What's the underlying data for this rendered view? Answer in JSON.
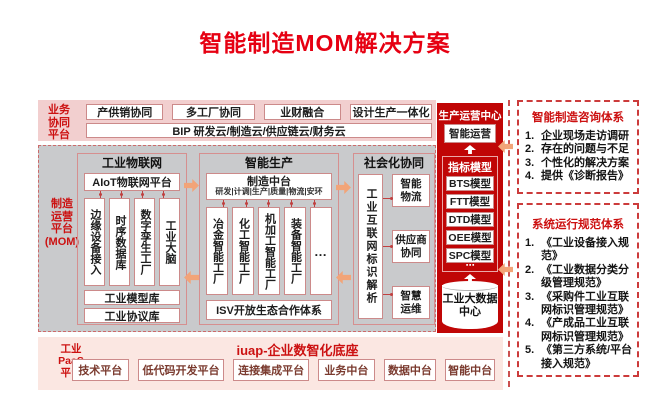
{
  "title": "智能制造MOM解决方案",
  "colors": {
    "accent": "#e60012",
    "panel_red": "#c00606",
    "arrow": "#f2a478",
    "band_pink": "#f2cfcf",
    "band_gray": "#c9cacc"
  },
  "layers": {
    "business": {
      "label": "业务协同平台",
      "boxes": [
        "产供销协同",
        "多工厂协同",
        "业财融合",
        "设计生产一体化"
      ],
      "bip": "BIP 研发云/制造云/供应链云/财务云"
    },
    "mom": {
      "label": "制造\n运营\n平台\n(MOM)",
      "iot": {
        "title": "工业物联网",
        "platform": "AIoT物联网平台",
        "columns": [
          "边缘设备接入",
          "时序数据库",
          "数字孪生工厂",
          "工业大脑"
        ],
        "libraries": [
          "工业模型库",
          "工业协议库"
        ]
      },
      "production": {
        "title": "智能生产",
        "hub": "制造中台",
        "hub_domains": "研发|计调|生产|质量|物流|安环",
        "factories": [
          "冶金智能工厂",
          "化工智能工厂",
          "机加工智能工厂",
          "装备智能工厂",
          "…"
        ],
        "isv": "ISV开放生态合作体系"
      },
      "social": {
        "title": "社会化协同",
        "resolver": "工业互联网标识解析",
        "items": [
          "智能\n物流",
          "供应商\n协同",
          "智慧\n运维"
        ]
      }
    },
    "paas": {
      "label": "工业\nPaaS\n平台",
      "title": "iuap-企业数智化底座",
      "boxes": [
        "技术平台",
        "低代码开发平台",
        "连接集成平台",
        "业务中台",
        "数据中台",
        "智能中台"
      ]
    }
  },
  "operation_center": {
    "title": "生产运营中心",
    "ops": "智能运营",
    "kpi": {
      "title": "指标模型",
      "models": [
        "BTS模型",
        "FTT模型",
        "DTD模型",
        "OEE模型",
        "SPC模型"
      ],
      "more": "⋯"
    },
    "datacenter": "工业大数据中心"
  },
  "consulting_panel": {
    "title": "智能制造咨询体系",
    "items": [
      {
        "no": "1.",
        "text": "企业现场走访调研"
      },
      {
        "no": "2.",
        "text": "存在的问题与不足"
      },
      {
        "no": "3.",
        "text": "个性化的解决方案"
      },
      {
        "no": "4.",
        "text": "提供《诊断报告》"
      }
    ]
  },
  "standards_panel": {
    "title": "系统运行规范体系",
    "items": [
      {
        "no": "1.",
        "text": "《工业设备接入规范》"
      },
      {
        "no": "2.",
        "text": "《工业数据分类分级管理规范》"
      },
      {
        "no": "3.",
        "text": "《采购件工业互联网标识管理规范》"
      },
      {
        "no": "4.",
        "text": "《产成品工业互联网标识管理规范》"
      },
      {
        "no": "5.",
        "text": "《第三方系统/平台接入规范》"
      }
    ]
  }
}
